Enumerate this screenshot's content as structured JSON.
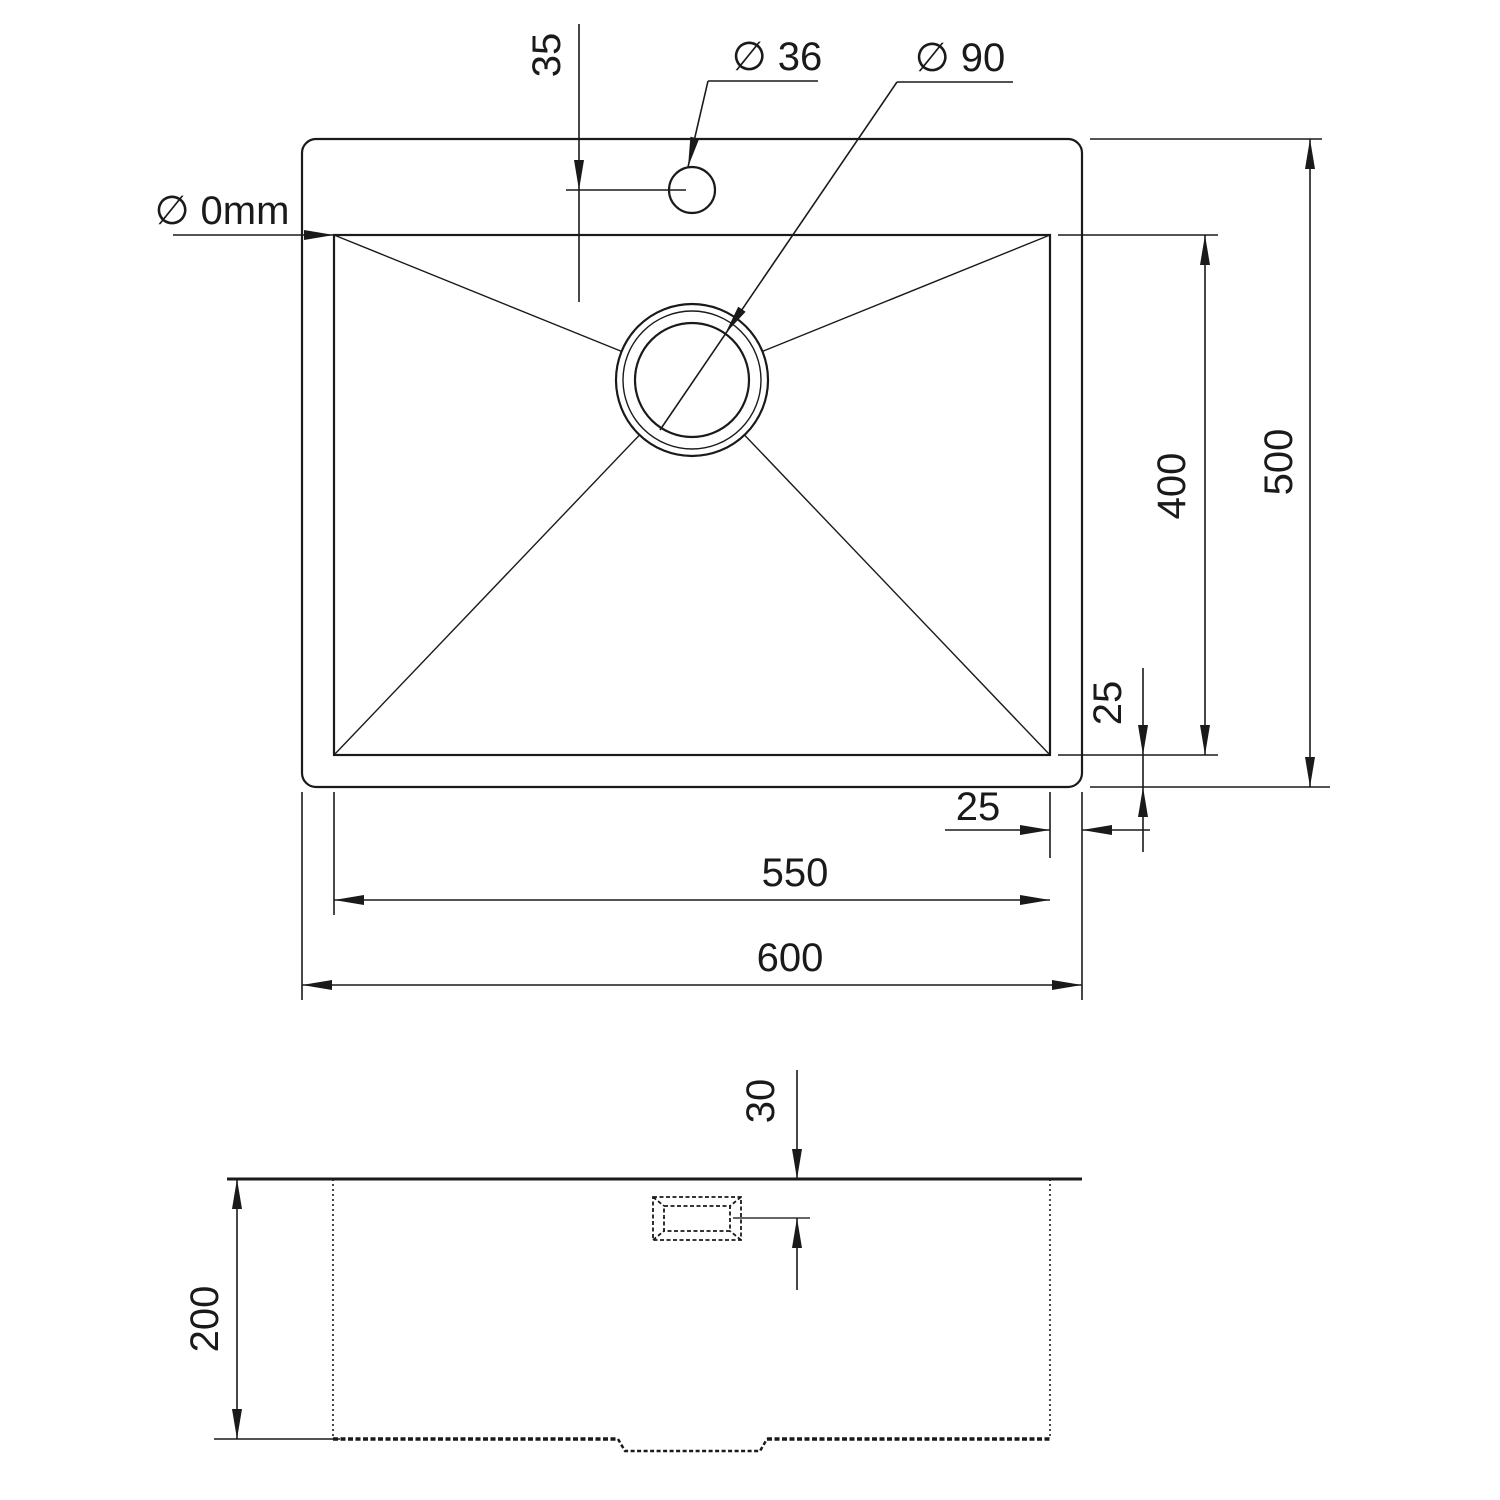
{
  "drawing": {
    "type": "sink-technical-drawing",
    "line_color": "#1a1a1a",
    "background_color": "#ffffff",
    "top_view": {
      "labels": {
        "faucet_offset": "35",
        "faucet_hole_diameter": "∅ 36",
        "drain_diameter": "∅ 90",
        "corner_radius": "∅ 0mm",
        "overall_depth": "500",
        "basin_depth": "400",
        "bottom_gap": "25",
        "right_gap": "25",
        "basin_width": "550",
        "overall_width": "600"
      }
    },
    "side_view": {
      "labels": {
        "overflow_offset": "30",
        "bowl_height": "200"
      }
    },
    "dimensions_mm": {
      "overall_width": 600,
      "overall_depth": 500,
      "basin_width": 550,
      "basin_depth": 400,
      "bowl_height": 200,
      "faucet_hole_diameter": 36,
      "drain_diameter": 90,
      "faucet_offset": 35,
      "edge_gap_right": 25,
      "edge_gap_bottom": 25,
      "overflow_offset": 30,
      "corner_radius": 0
    }
  }
}
